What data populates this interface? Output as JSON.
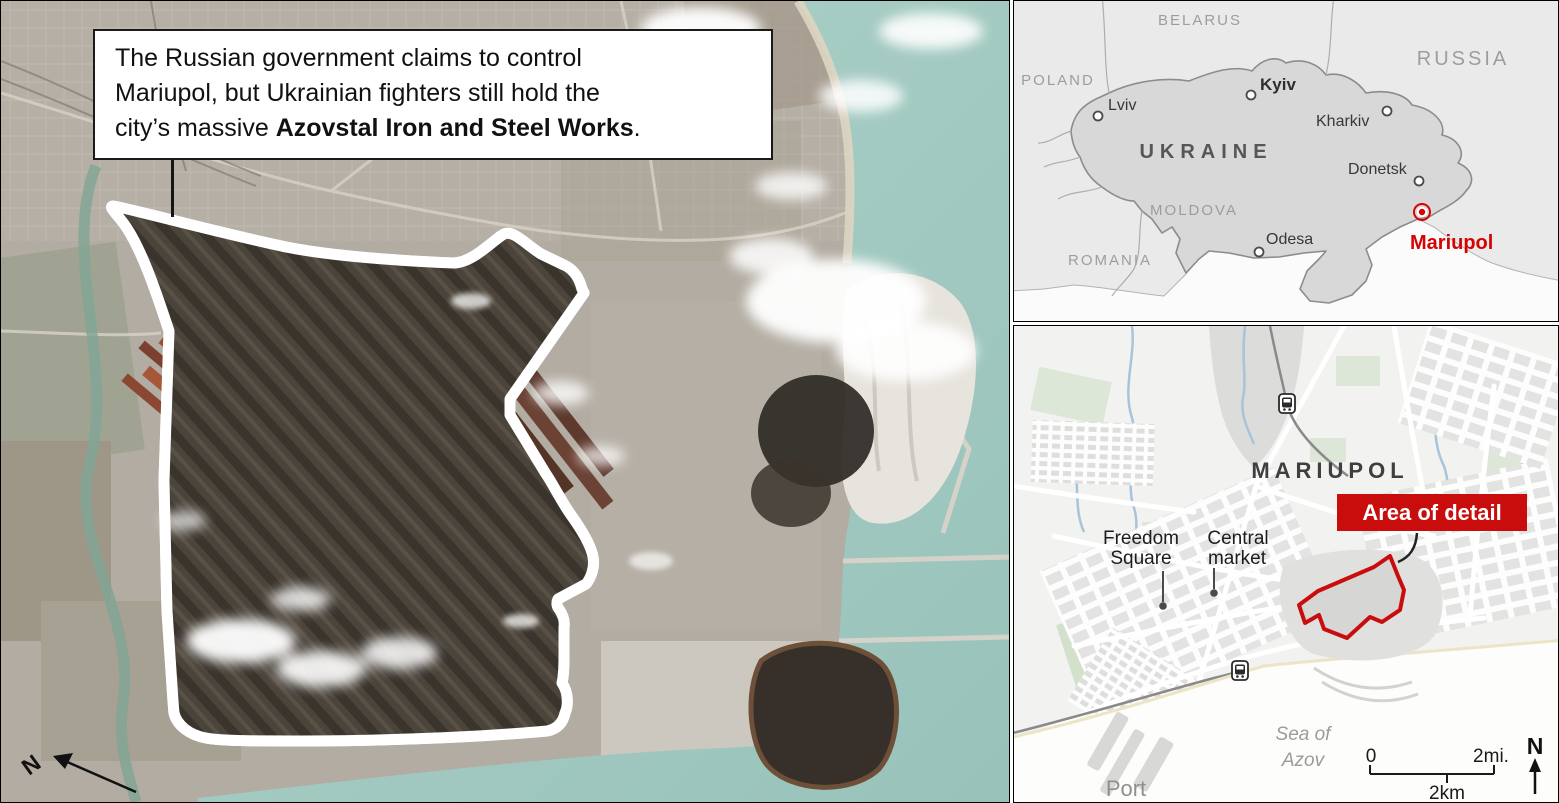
{
  "colors": {
    "accent_red": "#c90d0d",
    "marker_red": "#d40404",
    "water_teal": "#a4cbc2",
    "map_land": "#eaeaea",
    "ukraine_fill": "#d8d8d8"
  },
  "satellite": {
    "caption_line1": "The Russian government claims to control",
    "caption_line2": "Mariupol, but Ukrainian fighters still hold the",
    "caption_line3_regular": "city’s massive ",
    "caption_line3_bold": "Azovstal Iron and Steel Works",
    "caption_line3_period": ".",
    "compass": "N"
  },
  "ukraine_map": {
    "countries": [
      "BELARUS",
      "RUSSIA",
      "POLAND",
      "UKRAINE",
      "MOLDOVA",
      "ROMANIA"
    ],
    "cities": [
      "Kyiv",
      "Lviv",
      "Kharkiv",
      "Donetsk",
      "Odesa"
    ],
    "highlight": "Mariupol"
  },
  "detail_map": {
    "city": "MARIUPOL",
    "area_label": "Area of detail",
    "freedom_square": [
      "Freedom",
      "Square"
    ],
    "central_market": [
      "Central",
      "market"
    ],
    "sea": [
      "Sea of",
      "Azov"
    ],
    "port": "Port",
    "scale_zero": "0",
    "scale_mi": "2mi.",
    "scale_km": "2km",
    "compass": "N"
  }
}
